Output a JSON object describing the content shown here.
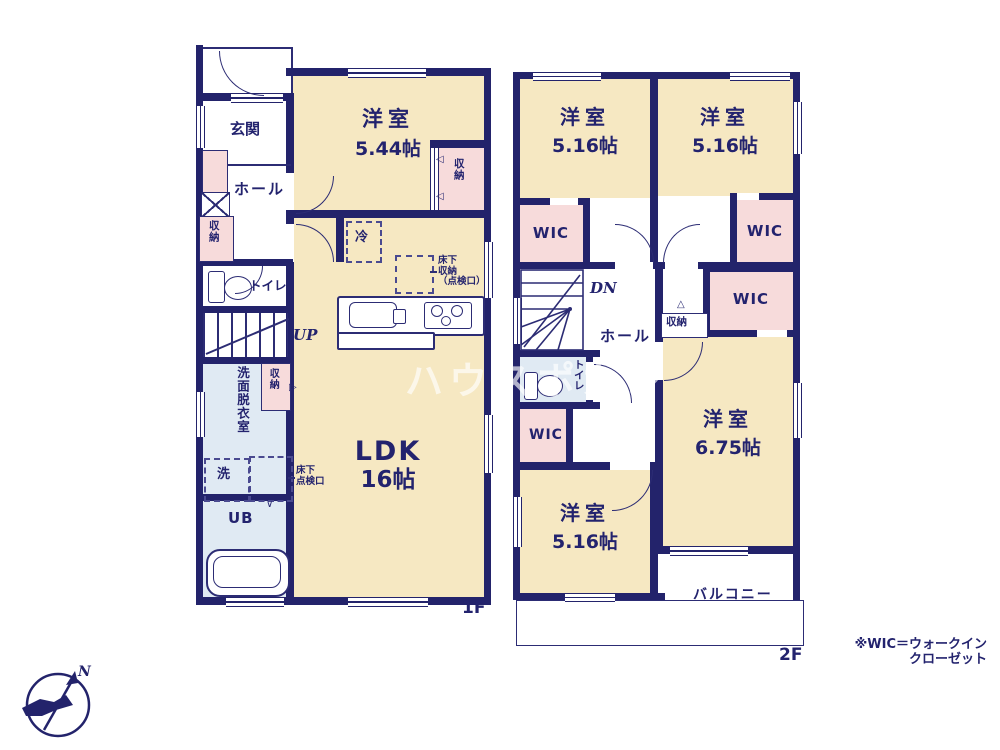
{
  "colors": {
    "wall_navy": "#23236b",
    "room_cream": "#f6e8c2",
    "closet_pink": "#f7dbdb",
    "wet_area_blue": "#e0eaf3",
    "text_navy": "#23236e",
    "watermark_white": "rgba(255,255,255,0.65)"
  },
  "watermark": "ハウスポカシ",
  "compass": {
    "north": "N"
  },
  "note": {
    "line1": "※WIC＝ウォークイン",
    "line2": "クローゼット"
  },
  "f1": {
    "floor_label": "1F",
    "genkan": "玄関",
    "hall": "ホール",
    "entry_storage": "収納",
    "toilet": "トイレ",
    "up": "UP",
    "washroom": "洗面脱衣室",
    "washroom_storage": "収納",
    "washer": "洗",
    "underfloor_hatch_l1": "床下",
    "underfloor_hatch_l2": "点検口",
    "ub": "UB",
    "bedroom_name": "洋室",
    "bedroom_size": "5.44帖",
    "bedroom_storage": "収納",
    "fridge": "冷",
    "underfloor_storage_l1": "床下",
    "underfloor_storage_l2": "収納",
    "underfloor_storage_l3": "（点検口）",
    "ldk_name": "LDK",
    "ldk_size": "16帖"
  },
  "f2": {
    "floor_label": "2F",
    "bedroom_tl_name": "洋室",
    "bedroom_tl_size": "5.16帖",
    "bedroom_tr_name": "洋室",
    "bedroom_tr_size": "5.16帖",
    "bedroom_right_name": "洋室",
    "bedroom_right_size": "6.75帖",
    "bedroom_bottom_name": "洋室",
    "bedroom_bottom_size": "5.16帖",
    "wic": "WIC",
    "hall": "ホール",
    "dn": "DN",
    "storage": "収納",
    "toilet": "トイレ",
    "balcony": "バルコニー"
  }
}
